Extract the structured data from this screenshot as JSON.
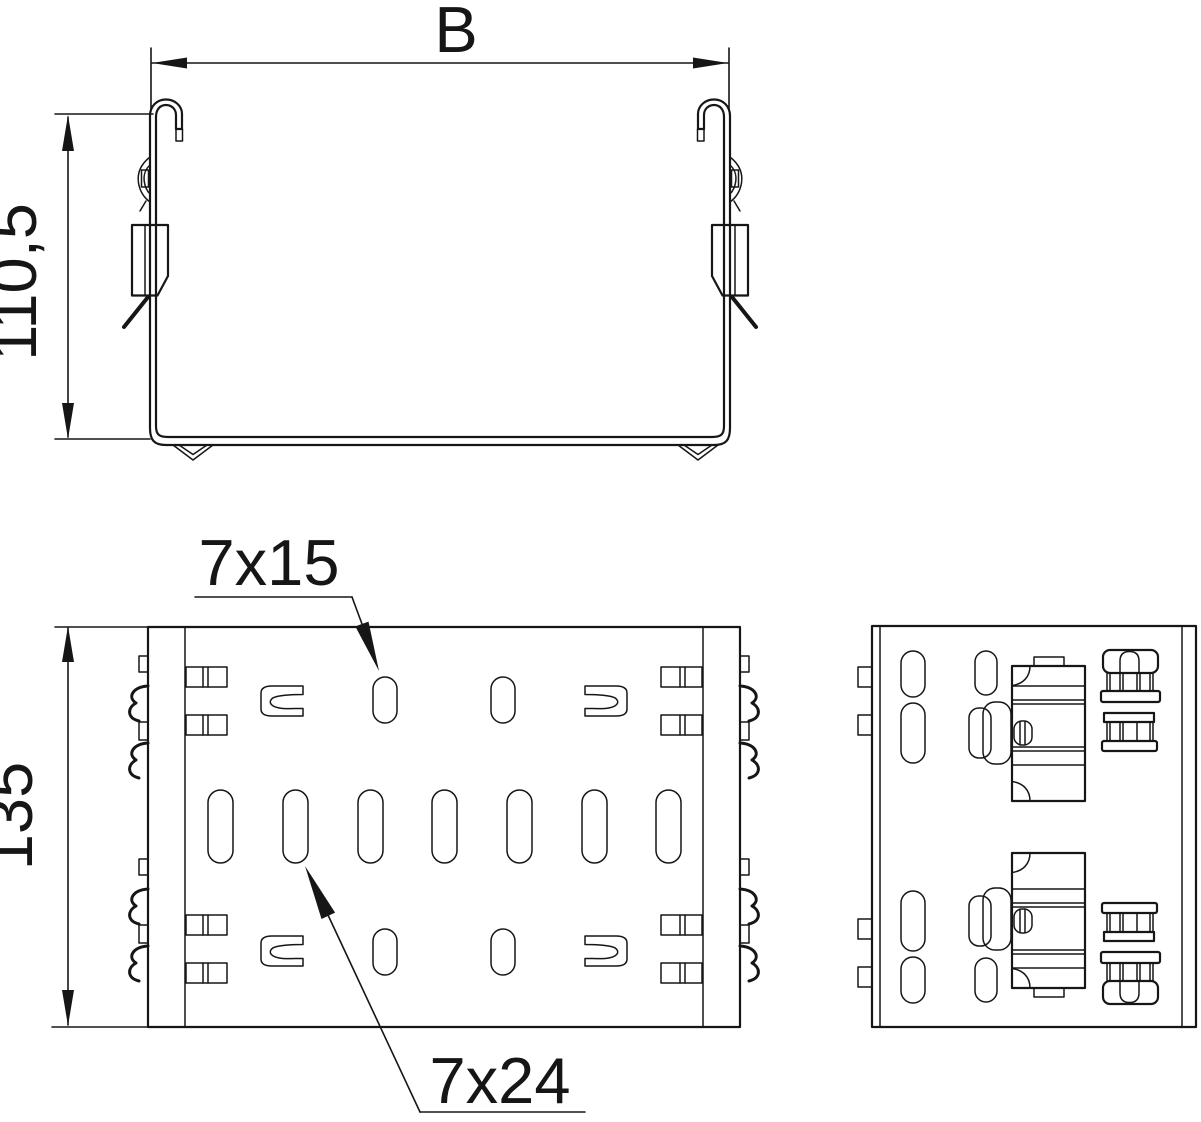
{
  "drawing": {
    "colors": {
      "line": "#161616",
      "background": "#ffffff"
    },
    "cross_section_view": {
      "width_label": "B",
      "height_label": "110,5"
    },
    "plan_view": {
      "length_label": "135",
      "slot_callout_small": "7x15",
      "slot_callout_large": "7x24"
    }
  }
}
